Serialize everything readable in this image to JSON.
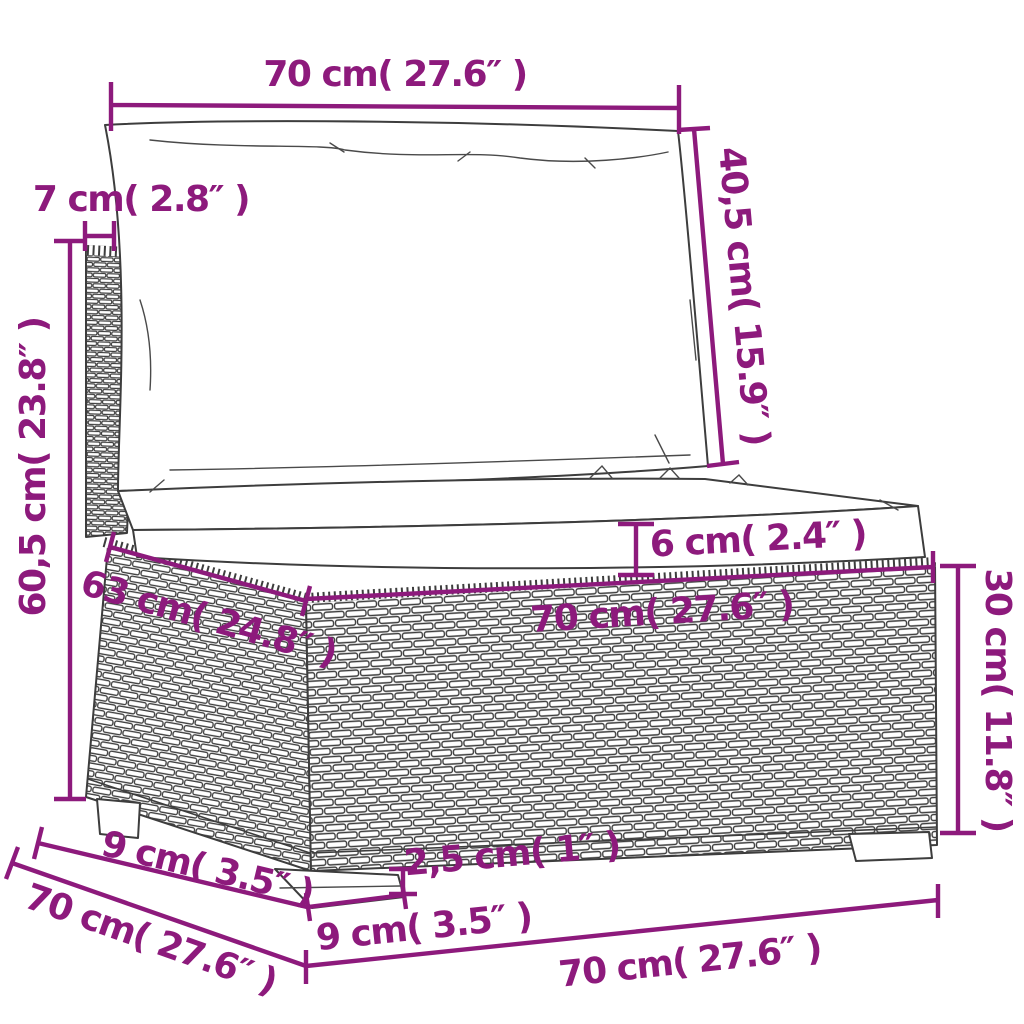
{
  "figure": {
    "title": "sofa-section-dimension-diagram",
    "colors": {
      "dimension_accent": "#8d1a7c",
      "line_art": "#3d3d3d",
      "background": "#ffffff"
    }
  },
  "dims": {
    "back_width": {
      "label": "70 cm( 27.6″ )"
    },
    "back_frame_thickness": {
      "label": "7 cm( 2.8″ )"
    },
    "back_cushion_height": {
      "label": "40,5 cm( 15.9″ )"
    },
    "overall_height": {
      "label": "60,5 cm( 23.8″ )"
    },
    "seat_cushion_thickness": {
      "label": "6 cm( 2.4″ )"
    },
    "seat_depth": {
      "label": "63 cm( 24.8″ )"
    },
    "seat_width": {
      "label": "70 cm( 27.6″ )"
    },
    "base_height": {
      "label": "30 cm( 11.8″ )"
    },
    "rail_height": {
      "label": "2,5 cm( 1″ )"
    },
    "leg_width": {
      "label": "9 cm( 3.5″ )"
    },
    "bottom_width": {
      "label": "70 cm( 27.6″ )"
    },
    "side_leg_offset": {
      "label": "9 cm( 3.5″ )"
    },
    "side_depth": {
      "label": "70 cm( 27.6″ )"
    }
  }
}
